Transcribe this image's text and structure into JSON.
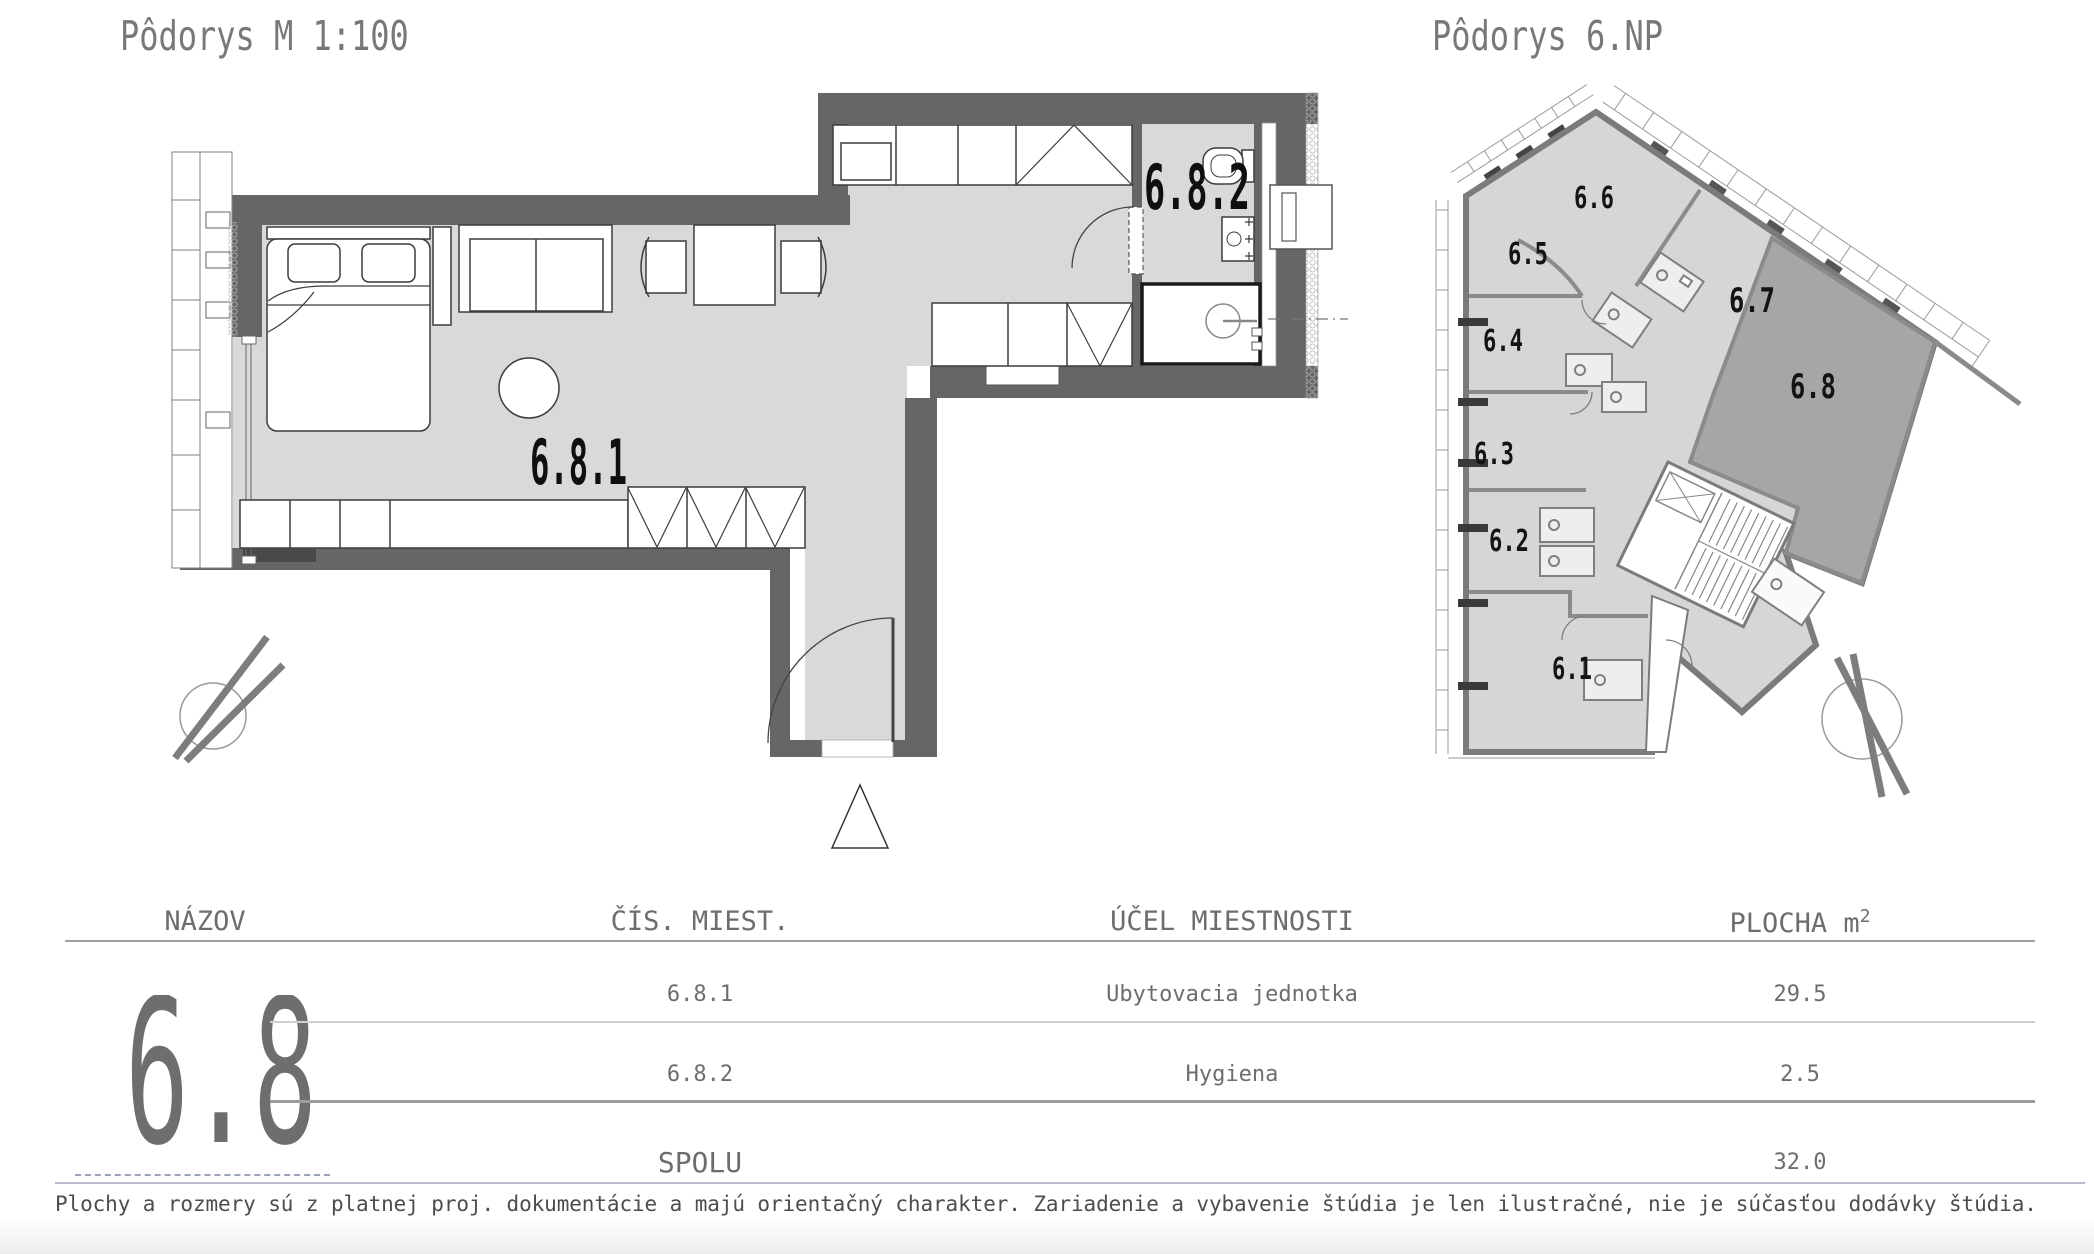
{
  "titles": {
    "detail": "Pôdorys M 1:100",
    "overview": "Pôdorys 6.NP"
  },
  "detail_plan": {
    "room_main": "6.8.1",
    "room_bath": "6.8.2"
  },
  "overview_plan": {
    "highlighted": "6.8",
    "units": [
      "6.1",
      "6.2",
      "6.3",
      "6.4",
      "6.5",
      "6.6",
      "6.7",
      "6.8"
    ]
  },
  "table": {
    "headers": {
      "name": "NÁZOV",
      "room_no": "ČÍS. MIEST.",
      "purpose": "ÚČEL MIESTNOSTI",
      "area_base": "PLOCHA m",
      "area_exp": "2"
    },
    "unit": "6.8",
    "rows": [
      {
        "room_no": "6.8.1",
        "purpose": "Ubytovacia jednotka",
        "area": "29.5"
      },
      {
        "room_no": "6.8.2",
        "purpose": "Hygiena",
        "area": "2.5"
      }
    ],
    "total": {
      "label": "SPOLU",
      "area": "32.0"
    }
  },
  "footer": {
    "disclaimer": "Plochy a rozmery sú z platnej proj. dokumentácie a majú orientačný charakter. Zariadenie a vybavenie štúdia je len ilustračné, nie je súčasťou dodávky štúdia."
  },
  "colors": {
    "wall": "#656668",
    "floor": "#d9d9d9",
    "overview_wall": "#7b7b7b",
    "overview_floor": "#d6d6d6",
    "highlight_unit": "#a6a6a6",
    "heading_text": "#787878",
    "table_text": "#6d6d6d",
    "footer_text": "#4d4d4d",
    "divider_blue": "#b6bcca"
  }
}
